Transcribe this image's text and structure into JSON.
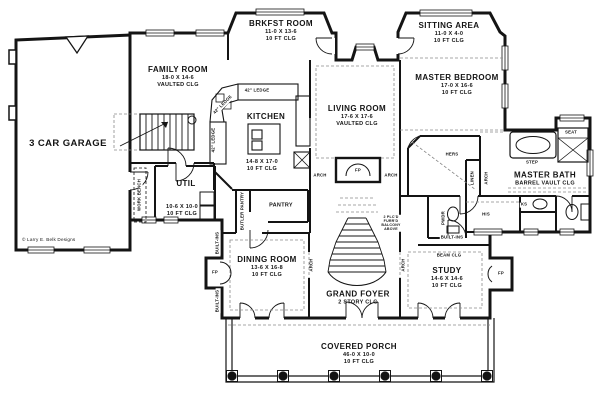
{
  "credit": "© Larry E. Belk Designs",
  "rooms": {
    "garage": {
      "name": "3 CAR GARAGE"
    },
    "family": {
      "name": "FAMILY ROOM",
      "dims": "18-0 X 14-6",
      "clg": "VAULTED CLG"
    },
    "brkfst": {
      "name": "BRKFST ROOM",
      "dims": "11-0 X 13-6",
      "clg": "10 FT CLG"
    },
    "kitchen": {
      "name": "KITCHEN",
      "dims": "14-8 X 17-0",
      "clg": "10 FT CLG"
    },
    "living": {
      "name": "LIVING ROOM",
      "dims": "17-6 X 17-6",
      "clg": "VAULTED CLG"
    },
    "sitting": {
      "name": "SITTING AREA",
      "dims": "11-0 X 4-0",
      "clg": "10 FT CLG"
    },
    "master_bedroom": {
      "name": "MASTER BEDROOM",
      "dims": "17-0 X 16-6",
      "clg": "10 FT CLG"
    },
    "master_bath": {
      "name": "MASTER BATH",
      "clg": "BARREL VAULT CLG"
    },
    "util": {
      "name": "UTIL",
      "dims": "10-6 X 10-0",
      "clg": "10 FT CLG"
    },
    "pantry": {
      "name": "PANTRY"
    },
    "dining": {
      "name": "DINING ROOM",
      "dims": "13-6 X 16-8",
      "clg": "10 FT CLG"
    },
    "foyer": {
      "name": "GRAND FOYER",
      "clg": "2 STORY CLG"
    },
    "study": {
      "name": "STUDY",
      "dims": "14-6 X 14-6",
      "clg": "10 FT CLG"
    },
    "porch": {
      "name": "COVERED PORCH",
      "dims": "46-0 X 10-0",
      "clg": "10 FT CLG"
    }
  },
  "annotations": {
    "fp": "FP",
    "arch": "ARCH",
    "hers": "HERS",
    "his": "HIS",
    "linen": "LINEN",
    "pwdr": "PWDR",
    "seat": "SEAT",
    "step": "STEP",
    "ks": "KS",
    "work_bench": "WORK BENCH",
    "butler_pantry": "BUTLER PANTRY",
    "built_ins": "BUILT-INS",
    "beam_clg": "BEAM CLG",
    "ledge": "42\" LEDGE",
    "balcony_note": "2 PLC'D\nFURR'D\nBALCONY\nABOVE"
  },
  "colors": {
    "ink": "#141414",
    "paper": "#ffffff",
    "dash": "#8a8a8a"
  }
}
